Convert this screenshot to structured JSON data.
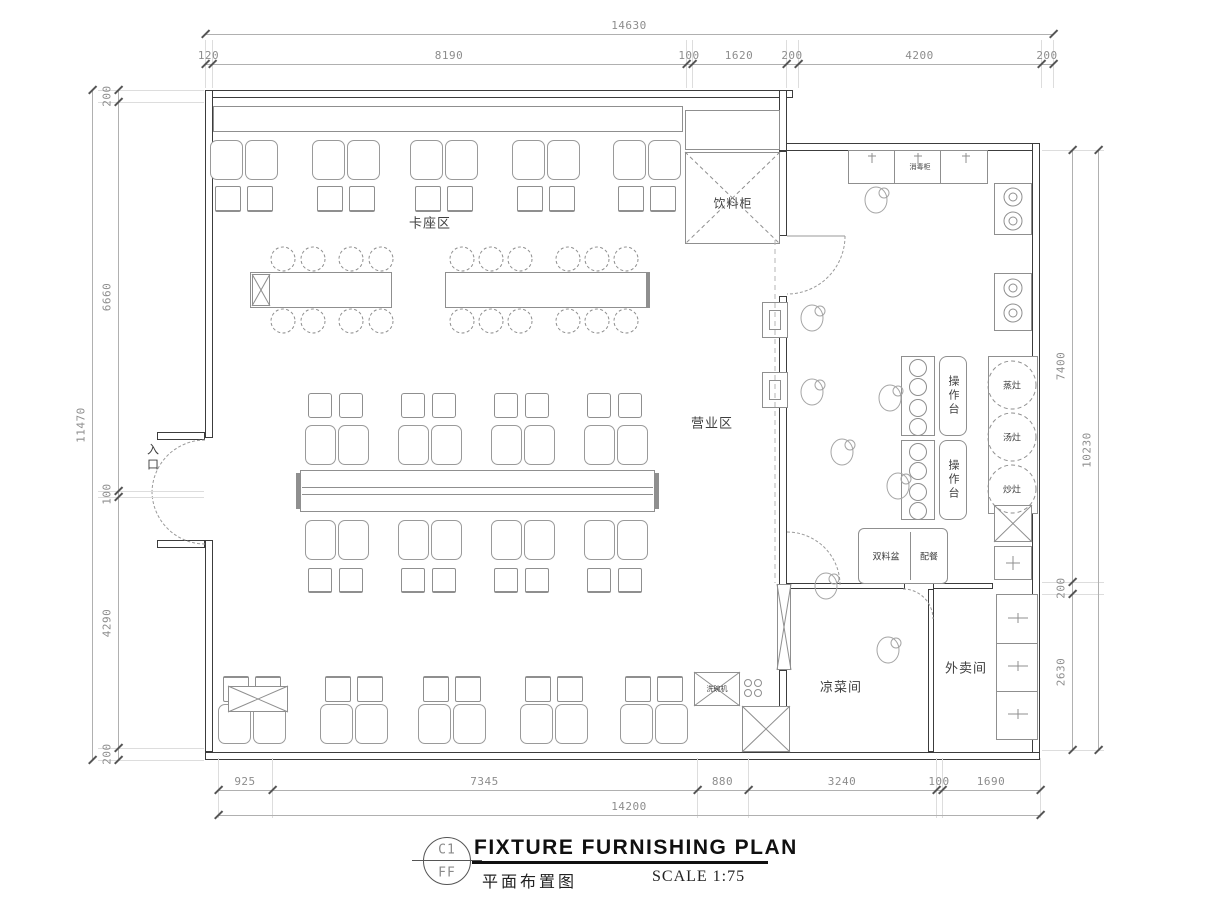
{
  "title_block": {
    "ref_top": "C1",
    "ref_bottom": "FF",
    "title": "FIXTURE FURNISHING PLAN",
    "subtitle": "平面布置图",
    "scale": "SCALE 1:75"
  },
  "rooms": {
    "entrance": "入口",
    "booth_area": "卡座区",
    "dining_area": "营业区",
    "cold_dish_room": "凉菜间",
    "takeout_room": "外卖间"
  },
  "equipment": {
    "drink_cabinet": "饮料柜",
    "op_counter_1": "操作台",
    "op_counter_2": "操作台",
    "stoves": [
      "蒸灶",
      "汤灶",
      "炒灶"
    ],
    "sink_counter_left": "双料盆",
    "sink_counter_right": "配餐",
    "disinfect_cabinet": "消毒柜",
    "dishwasher": "洗碗机"
  },
  "dimensions": {
    "top": {
      "total": "14630",
      "chain": [
        "120",
        "8190",
        "100",
        "1620",
        "200",
        "4200",
        "200"
      ]
    },
    "bottom": {
      "total": "14200",
      "chain": [
        "925",
        "7345",
        "880",
        "3240",
        "100",
        "1690"
      ]
    },
    "left": {
      "total": "11470",
      "chain": [
        "200",
        "6660",
        "100",
        "4290",
        "200"
      ]
    },
    "right": {
      "total": "10230",
      "chain": [
        "7400",
        "200",
        "2630"
      ]
    }
  }
}
